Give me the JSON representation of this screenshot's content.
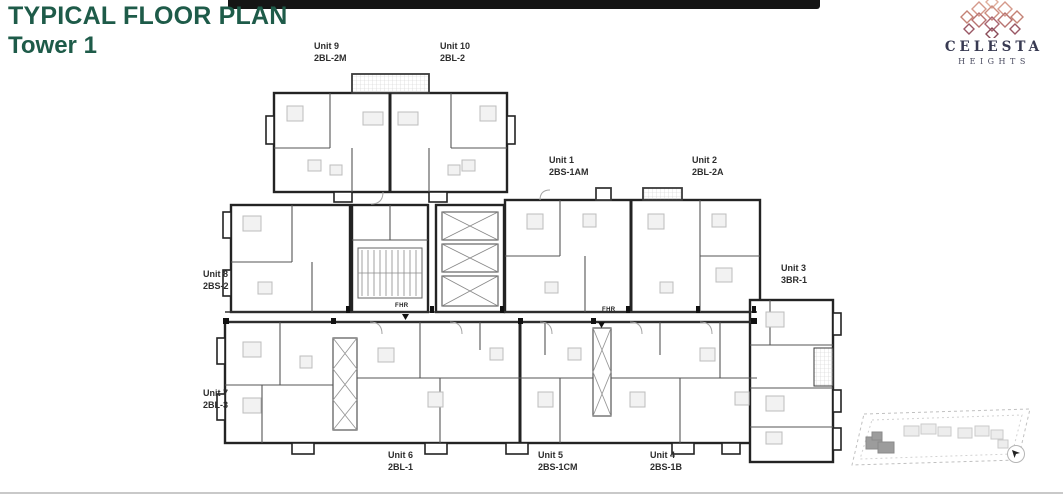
{
  "slide": {
    "title": "TYPICAL FLOOR PLAN",
    "subtitle": "Tower 1",
    "title_color": "#1e5b49",
    "accent_bar_color": "#151515",
    "divider_color": "#c9c9c9"
  },
  "brand": {
    "name": "CELESTA",
    "tagline": "HEIGHTS",
    "text_color": "#383a52",
    "motif_colors": [
      "#dfae9c",
      "#d5998b",
      "#c48275",
      "#a96470",
      "#8a4b58"
    ]
  },
  "floor_plan": {
    "units": [
      {
        "label": "Unit 9",
        "code": "2BL-2M"
      },
      {
        "label": "Unit 10",
        "code": "2BL-2"
      },
      {
        "label": "Unit 1",
        "code": "2BS-1AM"
      },
      {
        "label": "Unit 2",
        "code": "2BL-2A"
      },
      {
        "label": "Unit 3",
        "code": "3BR-1"
      },
      {
        "label": "Unit 8",
        "code": "2BS-2"
      },
      {
        "label": "Unit 7",
        "code": "2BL-3"
      },
      {
        "label": "Unit 6",
        "code": "2BL-1"
      },
      {
        "label": "Unit 5",
        "code": "2BS-1CM"
      },
      {
        "label": "Unit 4",
        "code": "2BS-1B"
      }
    ],
    "annotations": [
      {
        "text": "FHR"
      },
      {
        "text": "FHR"
      }
    ]
  },
  "key_map": {
    "current_tower_color": "#9c9c9c",
    "outline_color": "#c0c0c0"
  }
}
